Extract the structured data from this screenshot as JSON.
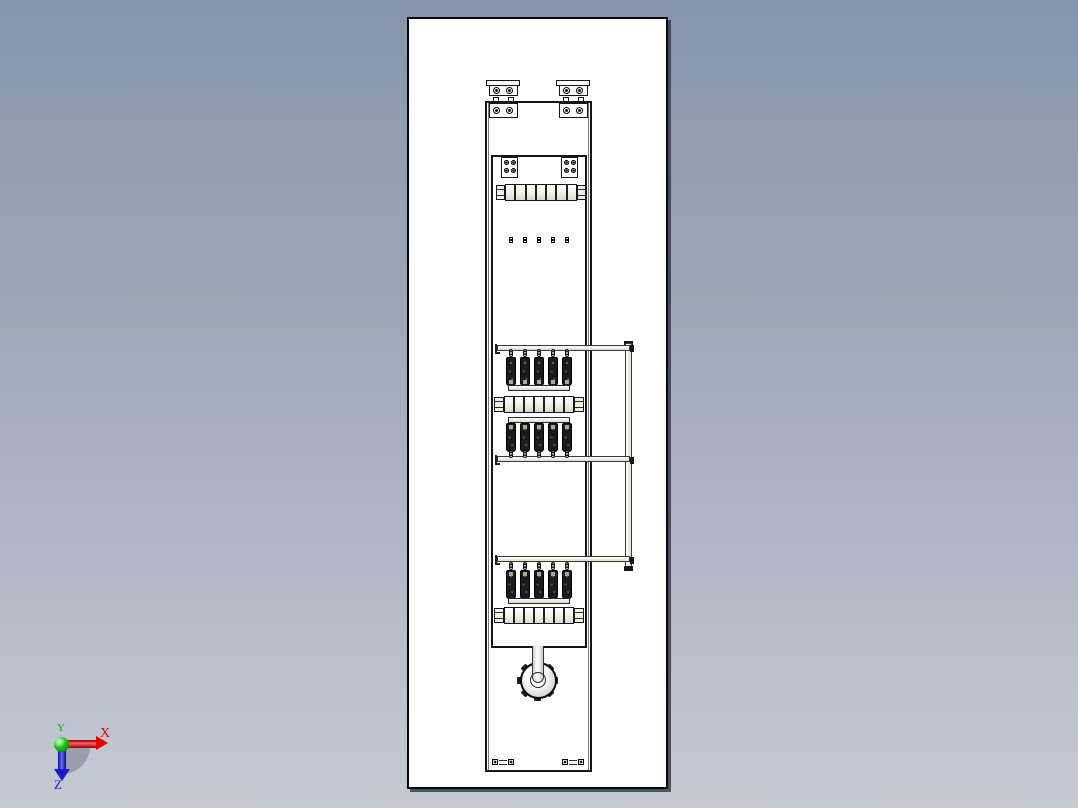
{
  "scene": {
    "background_top": "#8794aa",
    "background_bottom": "#c5cad3",
    "sheet_color": "#ffffff",
    "line_color": "#15151a",
    "metal_color": "#efefe3",
    "fuse_color": "#1b1b1b"
  },
  "triad": {
    "x": {
      "label": "X",
      "color": "#e60000"
    },
    "y": {
      "label": "Y",
      "color": "#00a800"
    },
    "z": {
      "label": "Z",
      "color": "#1a1acc"
    }
  },
  "model": {
    "name": "vertical-fuse-switch-disconnector",
    "fuses_per_row": 5,
    "fuse_rows": 3,
    "busbar_segments": 7,
    "terminal_count": 5,
    "dot_count": 5,
    "tooth_count": 7,
    "bracket_count": 2,
    "support_arm_count": 3
  }
}
